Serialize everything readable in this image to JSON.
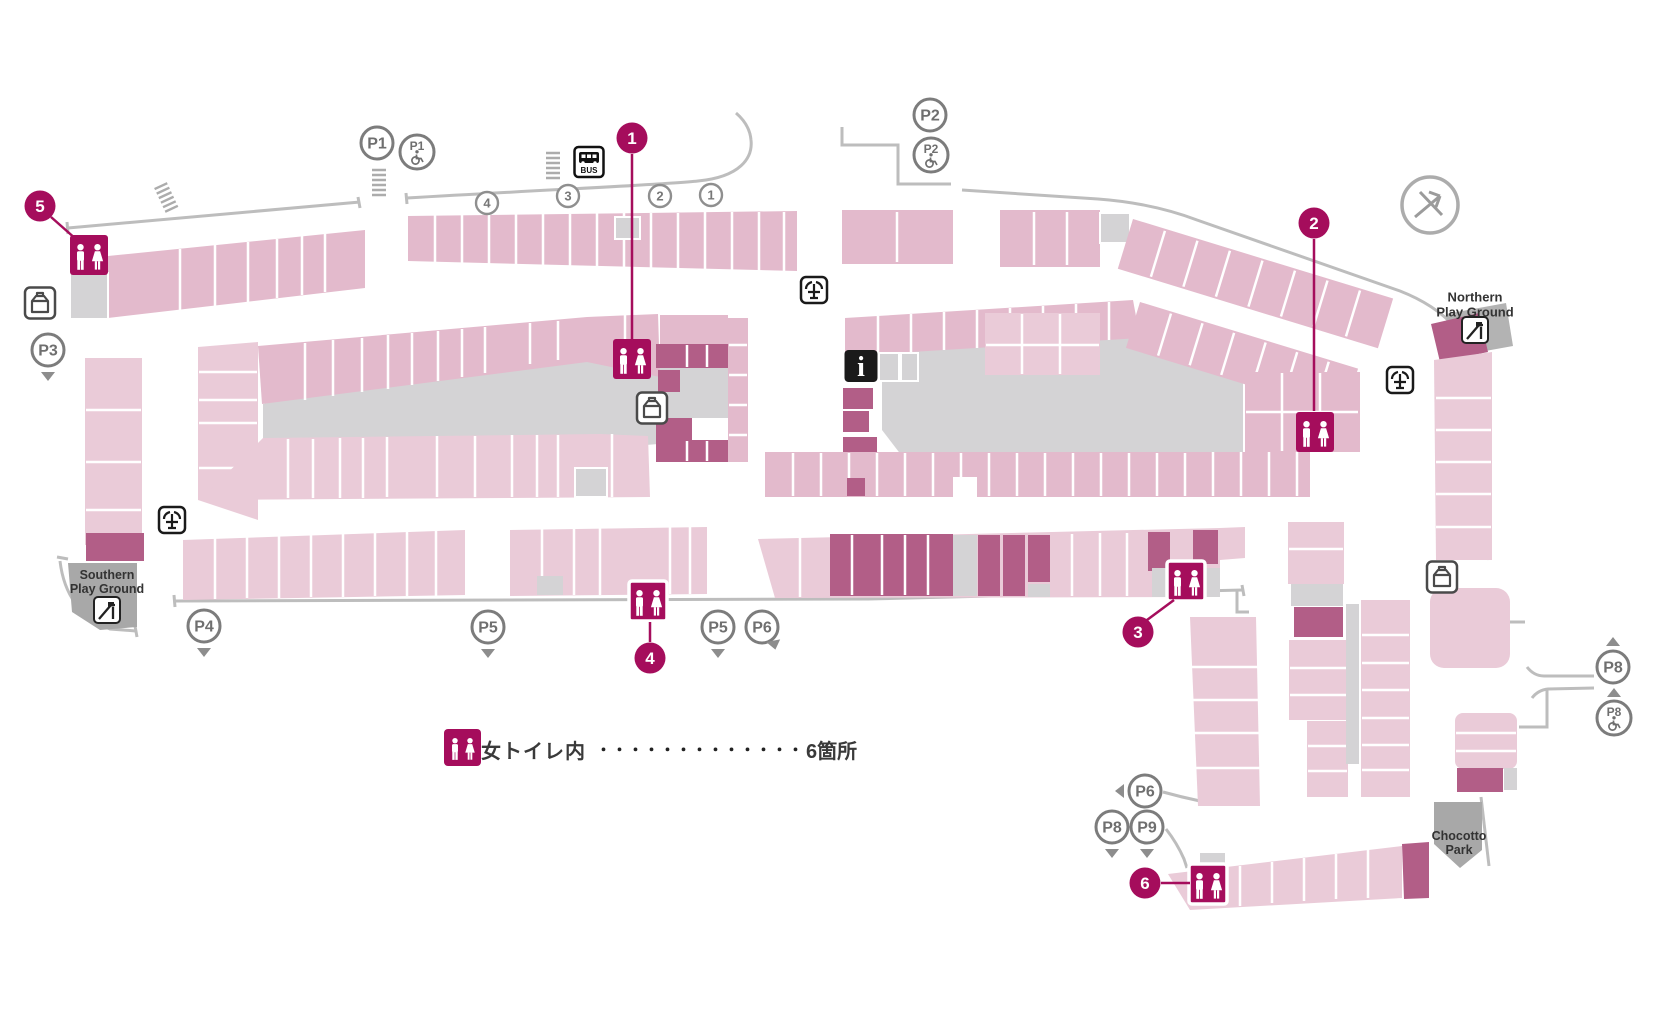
{
  "palette": {
    "pink_a": "#E3BACC",
    "pink_b": "#EACBD8",
    "dark_mauve": "#B25E87",
    "magenta": "#A50D5C",
    "gray_block": "#D4D3D5",
    "gray_mid": "#B3B3B3",
    "gray_dark": "#A8A8A8",
    "road": "#BDBDBD",
    "badge_gray": "#7C7C7C",
    "badge_text": "#6F6F6F",
    "label_text": "#333333"
  },
  "legend": {
    "label": "男女トイレ内",
    "dots": "・・・・・・・・・・・・・",
    "count": "6箇所"
  },
  "labels": {
    "northern": [
      "Northern",
      "Play Ground"
    ],
    "southern": [
      "Southern",
      "Play Ground"
    ],
    "chocotto": [
      "Chocotto",
      "Park"
    ]
  },
  "bus_sign_label": "BUS",
  "toilet_markers": [
    {
      "n": "1",
      "cx": 632,
      "cy": 138,
      "line": [
        632,
        154,
        632,
        340
      ]
    },
    {
      "n": "2",
      "cx": 1314,
      "cy": 223,
      "line": [
        1314,
        239,
        1314,
        411
      ]
    },
    {
      "n": "3",
      "cx": 1138,
      "cy": 632,
      "line": [
        1147,
        620,
        1174,
        600
      ]
    },
    {
      "n": "4",
      "cx": 650,
      "cy": 658,
      "line": [
        650,
        642,
        650,
        622
      ]
    },
    {
      "n": "5",
      "cx": 40,
      "cy": 206,
      "line": [
        51,
        217,
        77,
        240
      ]
    },
    {
      "n": "6",
      "cx": 1145,
      "cy": 883,
      "line": [
        1161,
        883,
        1190,
        883
      ]
    }
  ],
  "toilet_icons": [
    {
      "id": "1",
      "cx": 632,
      "cy": 359,
      "ring": false
    },
    {
      "id": "2",
      "cx": 1315,
      "cy": 432,
      "ring": false
    },
    {
      "id": "3",
      "cx": 1186,
      "cy": 581,
      "ring": true
    },
    {
      "id": "4",
      "cx": 648,
      "cy": 601,
      "ring": true
    },
    {
      "id": "5",
      "cx": 89,
      "cy": 255,
      "ring": false
    },
    {
      "id": "6",
      "cx": 1208,
      "cy": 884,
      "ring": true
    }
  ],
  "parking_badges": [
    {
      "label": "P1",
      "cx": 377,
      "cy": 143,
      "accessible": false,
      "arrow": null
    },
    {
      "label": "P1",
      "cx": 417,
      "cy": 152,
      "accessible": true,
      "arrow": null
    },
    {
      "label": "P2",
      "cx": 930,
      "cy": 115,
      "accessible": false,
      "arrow": null
    },
    {
      "label": "P2",
      "cx": 931,
      "cy": 155,
      "accessible": true,
      "arrow": null
    },
    {
      "label": "P3",
      "cx": 48,
      "cy": 350,
      "accessible": false,
      "arrow": "down"
    },
    {
      "label": "P4",
      "cx": 204,
      "cy": 626,
      "accessible": false,
      "arrow": "down"
    },
    {
      "label": "P5",
      "cx": 488,
      "cy": 627,
      "accessible": false,
      "arrow": "down"
    },
    {
      "label": "P5",
      "cx": 718,
      "cy": 627,
      "accessible": false,
      "arrow": "down"
    },
    {
      "label": "P6",
      "cx": 762,
      "cy": 627,
      "accessible": false,
      "arrow": "ne"
    },
    {
      "label": "P6",
      "cx": 1145,
      "cy": 791,
      "accessible": false,
      "arrow": "left"
    },
    {
      "label": "P8",
      "cx": 1112,
      "cy": 827,
      "accessible": false,
      "arrow": "down"
    },
    {
      "label": "P9",
      "cx": 1147,
      "cy": 827,
      "accessible": false,
      "arrow": "down"
    },
    {
      "label": "P8",
      "cx": 1613,
      "cy": 667,
      "accessible": false,
      "arrow": "up"
    },
    {
      "label": "P8",
      "cx": 1614,
      "cy": 718,
      "accessible": true,
      "arrow": "up"
    }
  ],
  "bus_stop_numbers": [
    {
      "label": "4",
      "cx": 487,
      "cy": 203
    },
    {
      "label": "3",
      "cx": 568,
      "cy": 196
    },
    {
      "label": "2",
      "cx": 660,
      "cy": 196
    },
    {
      "label": "1",
      "cx": 711,
      "cy": 195
    }
  ],
  "map_icons": [
    {
      "type": "bus",
      "cx": 589,
      "cy": 162
    },
    {
      "type": "info",
      "cx": 861,
      "cy": 366
    },
    {
      "type": "fountain",
      "cx": 814,
      "cy": 290
    },
    {
      "type": "fountain",
      "cx": 1400,
      "cy": 380
    },
    {
      "type": "fountain",
      "cx": 172,
      "cy": 520
    },
    {
      "type": "locker",
      "cx": 40,
      "cy": 303
    },
    {
      "type": "locker",
      "cx": 652,
      "cy": 408
    },
    {
      "type": "locker",
      "cx": 1442,
      "cy": 577
    },
    {
      "type": "slide",
      "cx": 1475,
      "cy": 330
    },
    {
      "type": "slide",
      "cx": 107,
      "cy": 610
    },
    {
      "type": "compass",
      "cx": 1430,
      "cy": 205
    },
    {
      "type": "stairs",
      "cx": 166,
      "cy": 197,
      "rot": -25
    },
    {
      "type": "stairs",
      "cx": 379,
      "cy": 182,
      "rot": 0
    },
    {
      "type": "stairs",
      "cx": 553,
      "cy": 165,
      "rot": 0
    }
  ]
}
